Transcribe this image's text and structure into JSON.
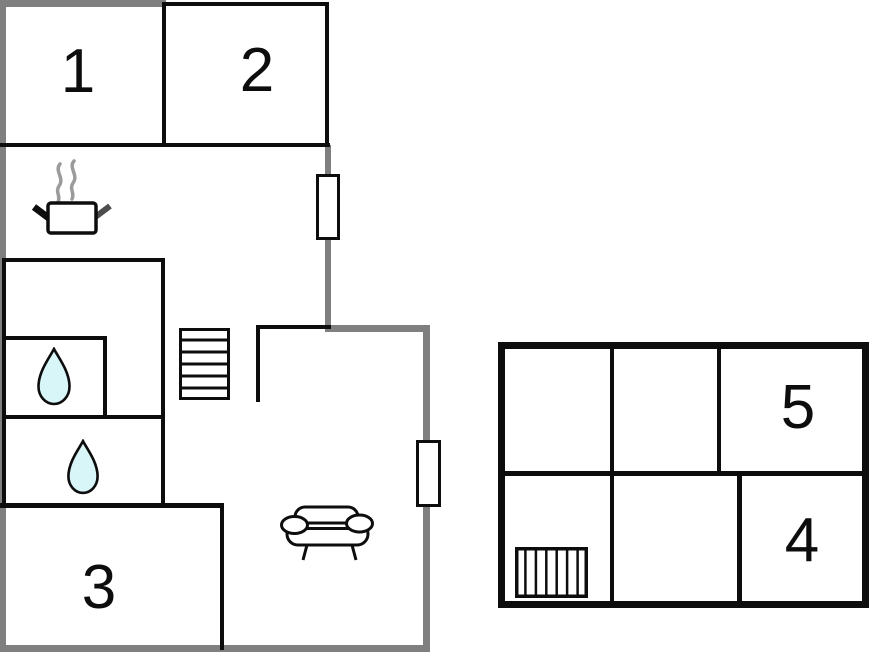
{
  "title": "Floor plan",
  "colors": {
    "background": "#ffffff",
    "outer_wall": "#7f7f7f",
    "inner_wall": "#0d0d0d",
    "drop_fill": "#d8f5f7",
    "steam": "#9b9b9b",
    "handle_dark": "#4d4d4d"
  },
  "left_building": {
    "name": "main building",
    "rooms": [
      {
        "label": "1"
      },
      {
        "label": "2"
      },
      {
        "label": "3"
      }
    ],
    "features": [
      "cooking-pot",
      "steam",
      "window",
      "window",
      "stairs",
      "water-drop",
      "water-drop",
      "sofa"
    ]
  },
  "right_building": {
    "name": "annex",
    "rooms": [
      {
        "label": "5"
      },
      {
        "label": "4"
      }
    ],
    "features": [
      "radiator"
    ]
  }
}
